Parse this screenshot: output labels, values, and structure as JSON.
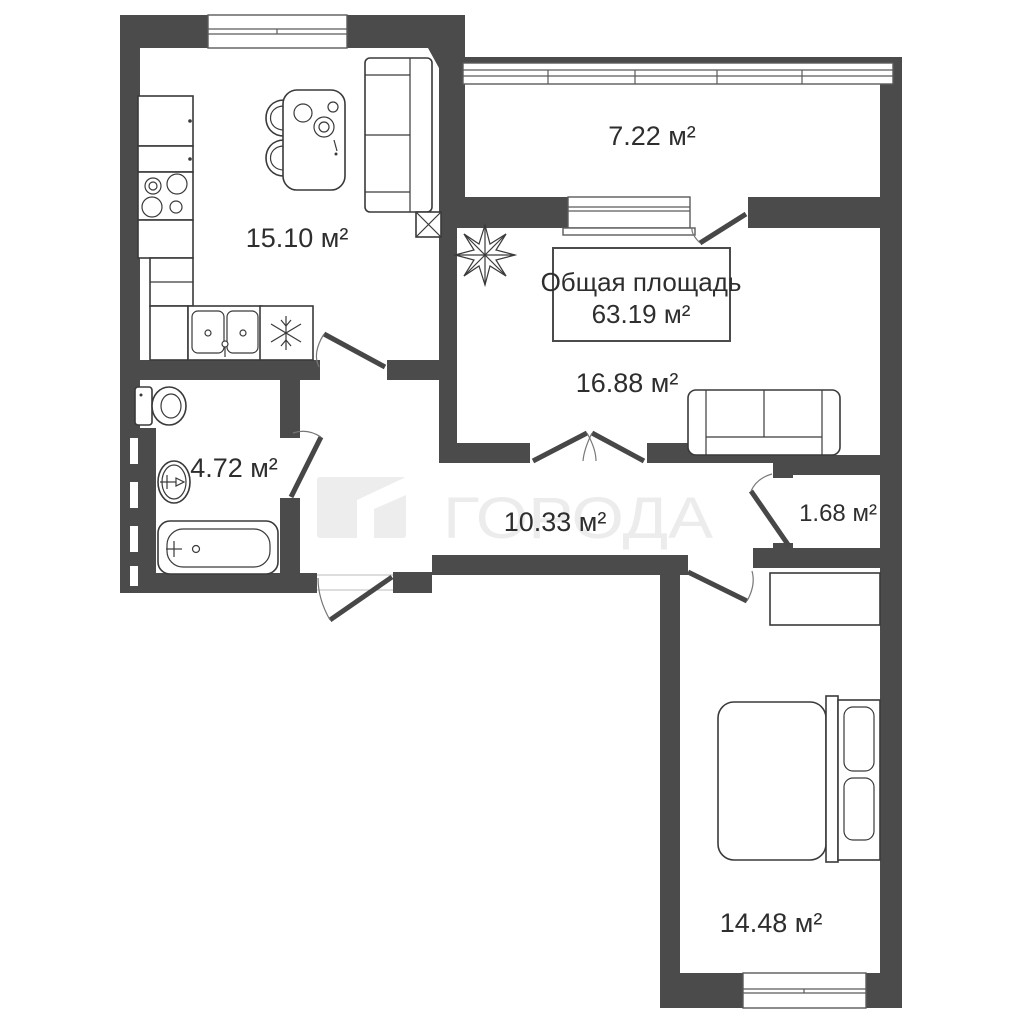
{
  "watermark": {
    "text": "ГОРОДА"
  },
  "total_area_box": {
    "line1": "Общая площадь",
    "line2": "63.19 м²"
  },
  "rooms": {
    "kitchen": {
      "name": "kitchen-living",
      "area": "15.10 м²"
    },
    "balcony": {
      "name": "balcony",
      "area": "7.22 м²"
    },
    "living": {
      "name": "living-room",
      "area": "16.88 м²"
    },
    "bathroom": {
      "name": "bathroom",
      "area": "4.72 м²"
    },
    "hallway": {
      "name": "hallway",
      "area": "10.33 м²"
    },
    "closet": {
      "name": "closet",
      "area": "1.68 м²"
    },
    "bedroom": {
      "name": "bedroom",
      "area": "14.48 м²"
    }
  },
  "symbols": {
    "snowflake_icon": "fridge-freezer",
    "x_box_icon": "ventilation-shaft",
    "plant_icon": "decorative-plant"
  },
  "colors": {
    "wall": "#4b4b4b",
    "furniture_line": "#3a3a3a",
    "text": "#2e2e2e",
    "watermark": "#ececec",
    "background": "#ffffff"
  }
}
